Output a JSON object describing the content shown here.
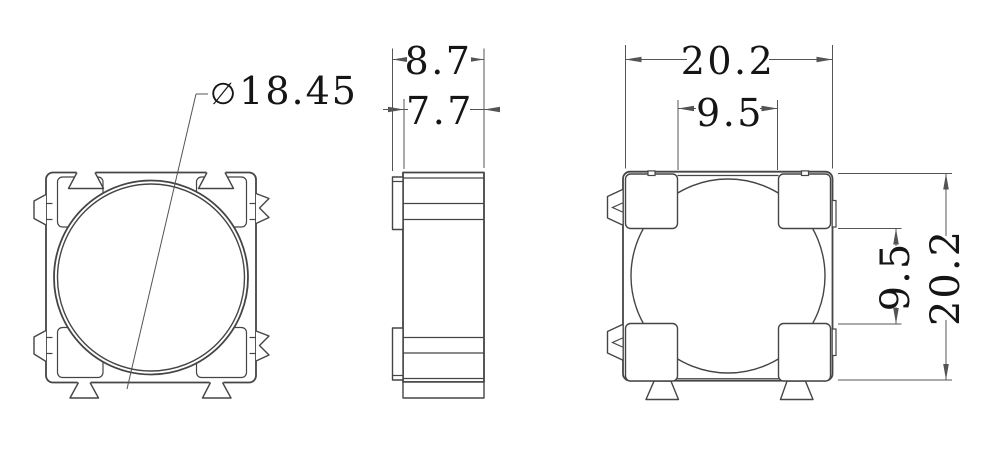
{
  "drawing": {
    "views": {
      "front": {
        "name": "front view with circular bore and corner pads"
      },
      "side": {
        "name": "side profile view"
      },
      "back": {
        "name": "back view with corner pads and mounting feet"
      }
    }
  },
  "colors": {
    "background": "#ffffff",
    "part_line": "#454545",
    "dim_line": "#545454",
    "text": "#151515"
  },
  "dimensions": {
    "diameter": {
      "symbol": "∅",
      "value": "18.45"
    },
    "side": {
      "outer_width": "8.7",
      "inner_width": "7.7"
    },
    "back": {
      "overall_width": "20.2",
      "pad_spacing_top": "9.5",
      "pad_spacing_right": "9.5",
      "overall_height": "20.2"
    }
  }
}
